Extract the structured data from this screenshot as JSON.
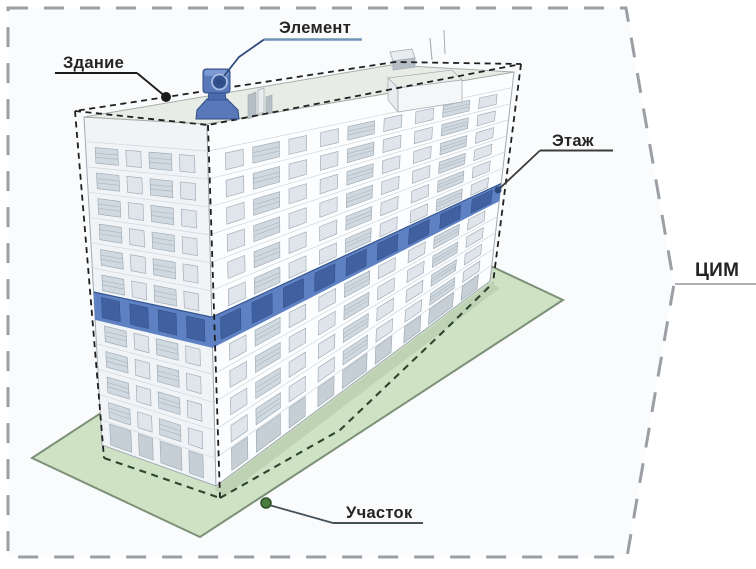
{
  "labels": {
    "building": "Здание",
    "element": "Элемент",
    "floor": "Этаж",
    "plot": "Участок",
    "model": "ЦИМ"
  },
  "colors": {
    "inner_bg": "#fafbfc",
    "outer_border": "#9b9fa4",
    "cim_leader": "#8f9398",
    "label_color": "#242424",
    "leader_dark": "#1b1b1b",
    "leader_mid": "#3c3c3c",
    "leader_blue": "#2c4a7e",
    "element_underline": "#7293b6",
    "plot_leader": "#46525a",
    "plot_marker": "#4b7d3f",
    "plot_marker_ring": "#2c4f26",
    "plot_fill": "#cfe2c4",
    "plot_stroke": "#7c9178",
    "plot_shadow": "#b5c8aa",
    "bbox_dash": "#1f1f1f",
    "footprint_dash": "#2b452e",
    "facade_left": "#f1f4f6",
    "facade_right": "#fcfdfe",
    "building_outline": "#9fa9b2",
    "roof_fill": "#e8ece7",
    "roof_outline": "#a6afa8",
    "floor_line": "#cfd6db",
    "window_fill": "#dfe5ea",
    "window_frame": "#9aa5af",
    "balcony_fill": "#d0d9e0",
    "balcony_line": "#aab4bd",
    "ground_opening": "#c6cfd6",
    "floor_band": "#5d81c2",
    "floor_band_edge": "#35548f",
    "floor_band_window": "#40609f",
    "floor_band_window_edge": "#2f4c85",
    "element_fill": "#5878ba",
    "element_light": "#7d99d1",
    "element_mid": "#4a6cae",
    "element_dark": "#2e4b82",
    "element_lens": "#33518f",
    "element_lens_ring": "#a8bce4",
    "structure_light": "#f4f6f7",
    "structure_mid": "#e8ecee",
    "structure_dark": "#b6bec5",
    "structure_outline": "#a6afb6"
  }
}
